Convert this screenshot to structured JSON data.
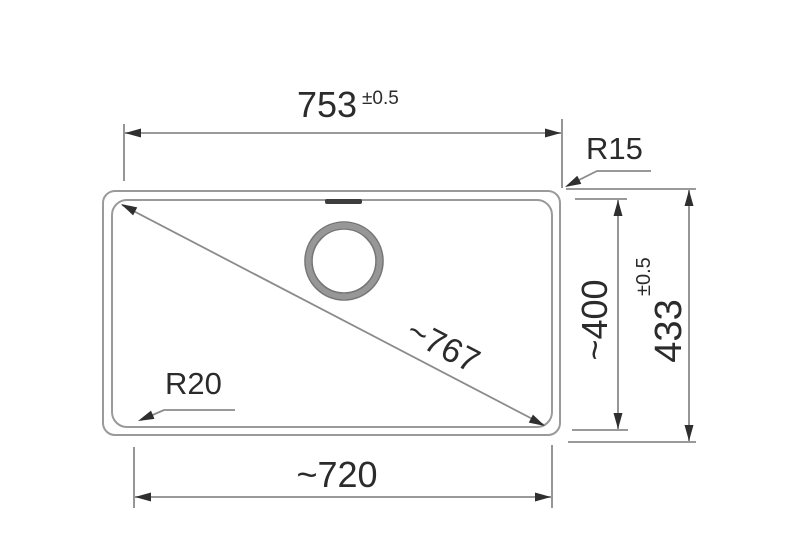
{
  "drawing": {
    "type": "technical-dimension-drawing",
    "subject": "sink-bowl-top-view",
    "colors": {
      "background": "#ffffff",
      "outline_gray": "#9a9a9a",
      "line_gray": "#8b8b8b",
      "text_dark": "#2b2b2b",
      "arrow_dark": "#2f2f2f",
      "drain_ring": "#979797",
      "overflow_slot": "#3d3d3d"
    },
    "labels": {
      "top_width": "753",
      "top_width_tolerance": "±0.5",
      "outer_height": "433",
      "outer_height_tolerance": "±0.5",
      "inner_height": "~400",
      "bottom_width": "~720",
      "diagonal": "~767",
      "radius_top_right": "R15",
      "radius_bottom_left": "R20"
    }
  }
}
